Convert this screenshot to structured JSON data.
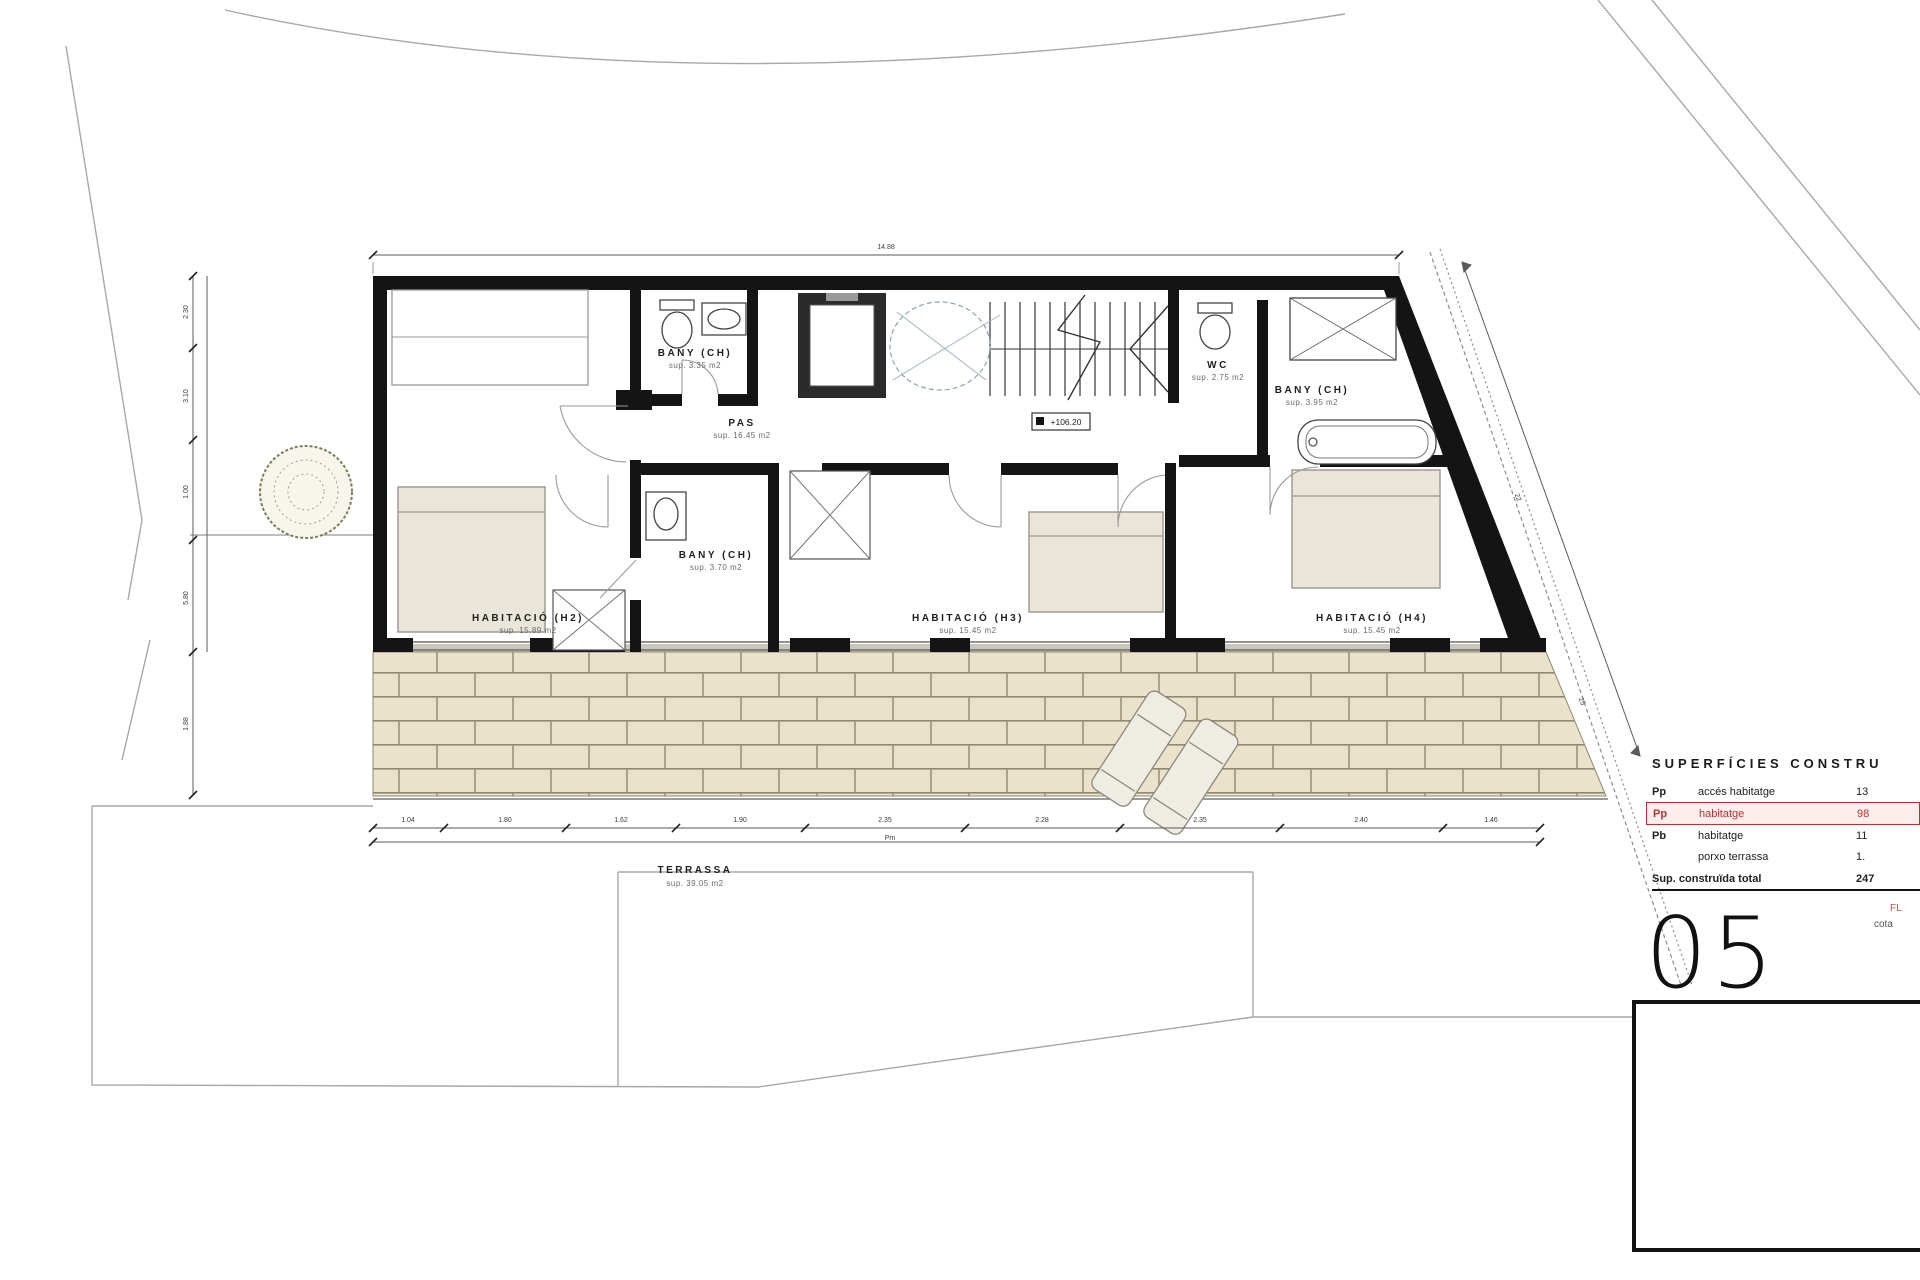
{
  "plan": {
    "rooms": [
      {
        "label": "BANY (CH)",
        "sup": "sup. 3.35 m2"
      },
      {
        "label": "PAS",
        "sup": "sup. 16.45 m2"
      },
      {
        "label": "BANY (CH)",
        "sup": "sup. 3.70 m2"
      },
      {
        "label": "WC",
        "sup": "sup. 2.75 m2"
      },
      {
        "label": "BANY (CH)",
        "sup": "sup. 3.95 m2"
      },
      {
        "label": "HABITACIÓ (H2)",
        "sup": "sup. 15.89 m2"
      },
      {
        "label": "HABITACIÓ (H3)",
        "sup": "sup. 15.45 m2"
      },
      {
        "label": "HABITACIÓ (H4)",
        "sup": "sup. 15.45 m2"
      },
      {
        "label": "TERRASSA",
        "sup": "sup. 39.05 m2"
      }
    ],
    "elevation_marker": "+106.20"
  },
  "dimensions": {
    "top_span": "14.88",
    "bottom_segments": [
      "1.04",
      "1.80",
      "1.62",
      "1.90",
      "2.35",
      "2.28",
      "2.35",
      "2.40",
      "1.46"
    ],
    "bottom_overall": "Pm",
    "left_segments": [
      "2.30",
      "3.10",
      "1.00",
      "5.80",
      "1.88"
    ],
    "slope_segments": [
      "22",
      "25"
    ]
  },
  "summary_table": {
    "title": "SUPERFÍCIES CONSTRU",
    "rows": [
      {
        "code": "Pp",
        "label": "accés habitatge",
        "value": "13"
      },
      {
        "code": "Pp",
        "label": "habitatge",
        "value": "98"
      },
      {
        "code": "Pb",
        "label": "habitatge",
        "value": "11"
      },
      {
        "code": "",
        "label": "porxo terrassa",
        "value": "1."
      }
    ],
    "total_label": "Sup. construïda total",
    "total_value": "247",
    "note_red": "FL",
    "note_gray": "cota"
  },
  "sheet": {
    "number": "05"
  },
  "colors": {
    "wall": "#141414",
    "line_gray": "#9a9a9a",
    "furniture_beige": "#e9e5d8",
    "brick": "#eae2ca",
    "brick_joint": "#8f8971",
    "highlight_red": "#b5352c"
  }
}
